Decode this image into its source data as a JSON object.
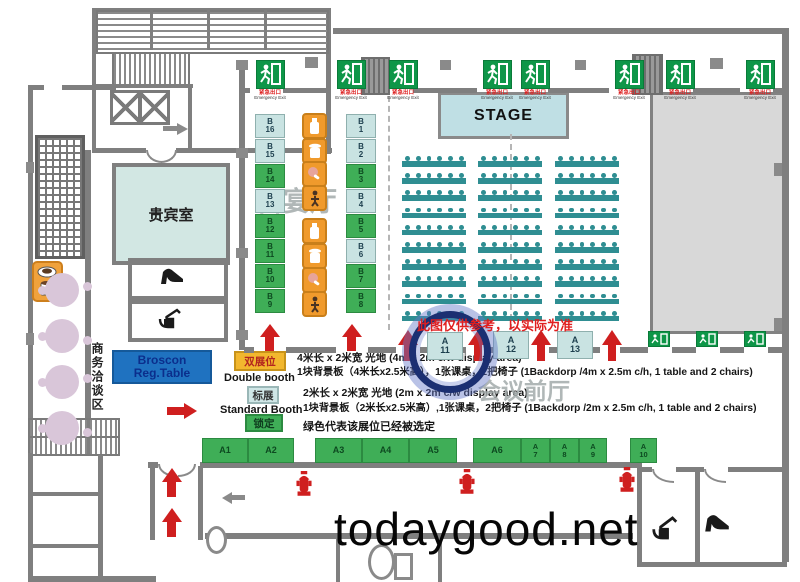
{
  "site_watermark": "todaygood.net",
  "rooms": {
    "stage": "STAGE",
    "vip": "贵宾室",
    "banquet_hall": "百宴厅",
    "front_hall": "会议前厅",
    "business_area": "商务洽谈区"
  },
  "reg_table": {
    "line1": "Broscon",
    "line2": "Reg.Table"
  },
  "disclaimer": "此图仅供参考，以实际为准",
  "exit_sign": {
    "cn": "紧急出口",
    "en": "Emergency Exit"
  },
  "legend": {
    "double": {
      "cn": "双展位",
      "en": "Double booth",
      "desc1": "4米长 x 2米宽 光地 (4m x 2m c/w display area)",
      "desc2": "1块背景板（4米长x2.5米高），1张课桌，2把椅子 (1Backdorp /4m x 2.5m c/h, 1 table and 2 chairs)"
    },
    "standard": {
      "cn": "标展",
      "en": "Standard Booth",
      "desc1": "2米长 x 2米宽 光地 (2m x 2m c/w display area)",
      "desc2": "1块背景板（2米长x2.5米高）,1张课桌，2把椅子 (1Backdorp /2m x 2.5m c/h, 1 table and 2 chairs)"
    },
    "locked": {
      "cn": "锁定",
      "desc": "绿色代表该展位已经被选定"
    }
  },
  "booths": {
    "b_left": [
      {
        "row": "B",
        "num": "16",
        "selected": false
      },
      {
        "row": "B",
        "num": "15",
        "selected": false
      },
      {
        "row": "B",
        "num": "14",
        "selected": true
      },
      {
        "row": "B",
        "num": "13",
        "selected": false
      },
      {
        "row": "B",
        "num": "12",
        "selected": true
      },
      {
        "row": "B",
        "num": "11",
        "selected": true
      },
      {
        "row": "B",
        "num": "10",
        "selected": true
      },
      {
        "row": "B",
        "num": "9",
        "selected": true
      }
    ],
    "b_right": [
      {
        "row": "B",
        "num": "1",
        "selected": false
      },
      {
        "row": "B",
        "num": "2",
        "selected": false
      },
      {
        "row": "B",
        "num": "3",
        "selected": true
      },
      {
        "row": "B",
        "num": "4",
        "selected": false
      },
      {
        "row": "B",
        "num": "5",
        "selected": true
      },
      {
        "row": "B",
        "num": "6",
        "selected": false
      },
      {
        "row": "B",
        "num": "7",
        "selected": true
      },
      {
        "row": "B",
        "num": "8",
        "selected": true
      }
    ],
    "a_top": [
      {
        "row": "A",
        "num": "11",
        "selected": false,
        "highlighted": true
      },
      {
        "row": "A",
        "num": "12",
        "selected": false,
        "highlighted": false
      },
      {
        "row": "A",
        "num": "13",
        "selected": false,
        "highlighted": false
      }
    ],
    "a_bottom": [
      {
        "label": "A1",
        "selected": true
      },
      {
        "label": "A2",
        "selected": true
      },
      {
        "label": "A3",
        "selected": true
      },
      {
        "label": "A4",
        "selected": true
      },
      {
        "label": "A5",
        "selected": true
      },
      {
        "label": "A6",
        "selected": true
      },
      {
        "row": "A",
        "num": "7",
        "selected": true
      },
      {
        "row": "A",
        "num": "8",
        "selected": true
      },
      {
        "row": "A",
        "num": "9",
        "selected": true
      },
      {
        "row": "A",
        "num": "10",
        "selected": true
      }
    ]
  },
  "seating": {
    "column_groups": 3,
    "rows": 10,
    "seats_per_table": 6
  },
  "colors": {
    "booth_selected": "#3fae57",
    "booth_available": "#c9e3e2",
    "arrow_red": "#cf1f1f",
    "exit_green": "#0e9648",
    "reg_table_blue": "#1f72c0",
    "double_booth_yellow": "#f2b72e",
    "table_teal": "#2f8e92",
    "wall_gray": "#7f7f7f"
  }
}
